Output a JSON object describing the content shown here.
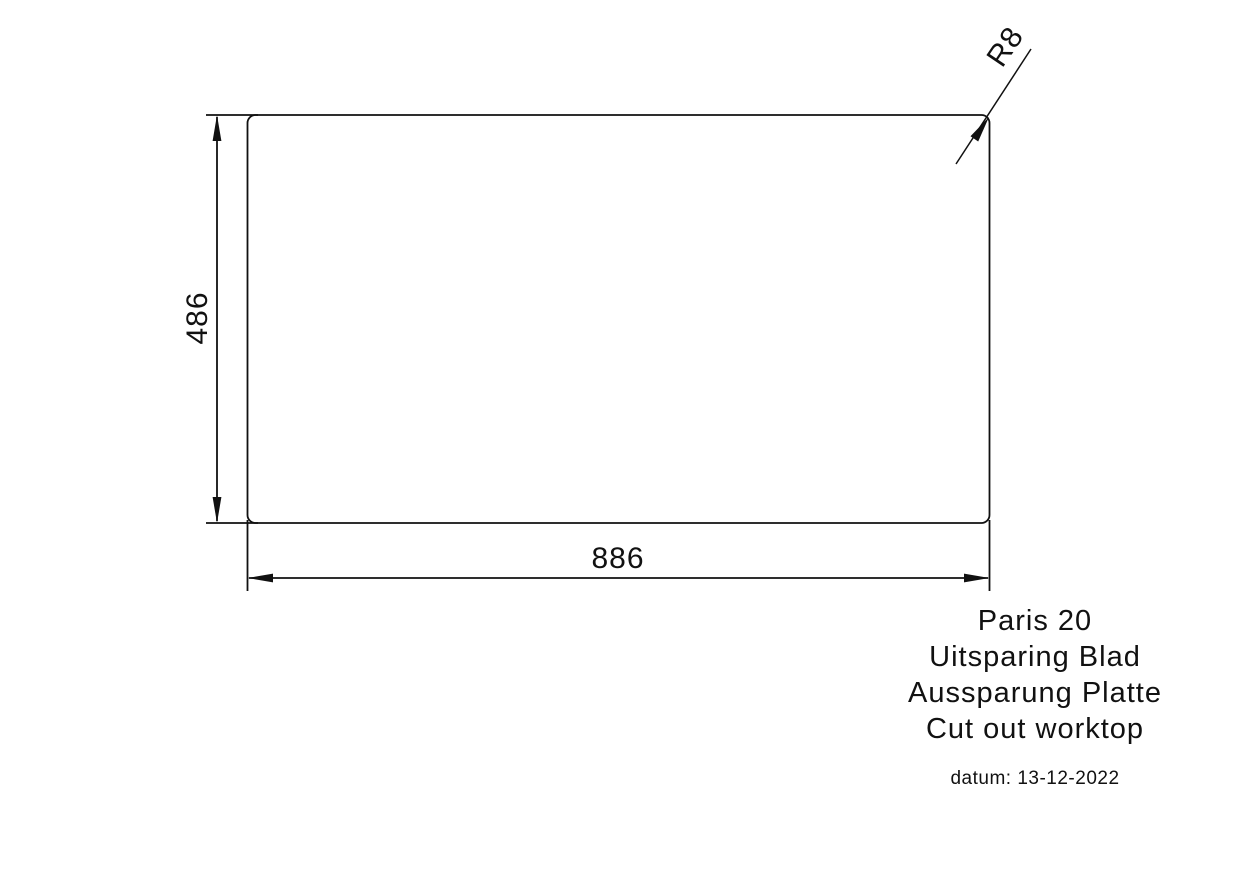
{
  "drawing": {
    "product_name": "Paris 20",
    "dimensions": {
      "width_label": "886",
      "height_label": "486",
      "corner_radius_label": "R8"
    },
    "title_block": {
      "lines": [
        "Paris 20",
        "Uitsparing Blad",
        "Aussparung Platte",
        "Cut out worktop"
      ],
      "date_label": "datum: 13-12-2022"
    },
    "colors": {
      "line": "#111111",
      "background": "#ffffff"
    }
  }
}
